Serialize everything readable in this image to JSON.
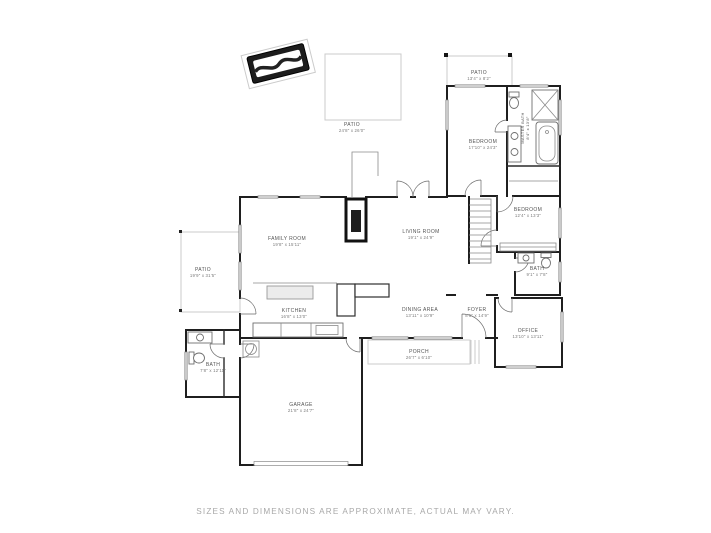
{
  "page": {
    "background": "#ffffff"
  },
  "colors": {
    "wall": "#1f1f1f",
    "thin_line": "#8a8a8a",
    "patio_outline": "#cbcbcb",
    "label_text": "#555555",
    "dims_text": "#7a7a7a",
    "disclaimer_text": "#a8a8a8"
  },
  "rooms": {
    "patio_top": {
      "name": "PATIO",
      "dims": "13'4\" x 8'2\""
    },
    "patio_center": {
      "name": "PATIO",
      "dims": "24'8\" x 26'0\""
    },
    "patio_left": {
      "name": "PATIO",
      "dims": "19'9\" x 31'5\""
    },
    "bedroom_primary": {
      "name": "BEDROOM",
      "dims": "17'10\" x 24'3\""
    },
    "master_bath": {
      "name": "MASTER BATH",
      "dims": "8'4\" x 13'8\""
    },
    "bedroom2": {
      "name": "BEDROOM",
      "dims": "12'4\" x 13'3\""
    },
    "family_room": {
      "name": "FAMILY ROOM",
      "dims": "19'8\" x 15'11\""
    },
    "living_room": {
      "name": "LIVING ROOM",
      "dims": "19'1\" x 24'9\""
    },
    "kitchen": {
      "name": "KITCHEN",
      "dims": "16'8\" x 13'0\""
    },
    "dining_area": {
      "name": "DINING AREA",
      "dims": "13'11\" x 10'9\""
    },
    "foyer": {
      "name": "FOYER",
      "dims": "8'5\" x 14'9\""
    },
    "bath_hall": {
      "name": "BATH",
      "dims": "9'1\" x 7'8\""
    },
    "office": {
      "name": "OFFICE",
      "dims": "13'10\" x 13'11\""
    },
    "porch": {
      "name": "PORCH",
      "dims": "26'7\" x 6'10\""
    },
    "bath_down": {
      "name": "BATH",
      "dims": "7'8\" x 12'11\""
    },
    "garage": {
      "name": "GARAGE",
      "dims": "21'8\" x 24'7\""
    }
  },
  "footer": {
    "disclaimer": "SIZES AND DIMENSIONS ARE APPROXIMATE, ACTUAL MAY VARY."
  }
}
